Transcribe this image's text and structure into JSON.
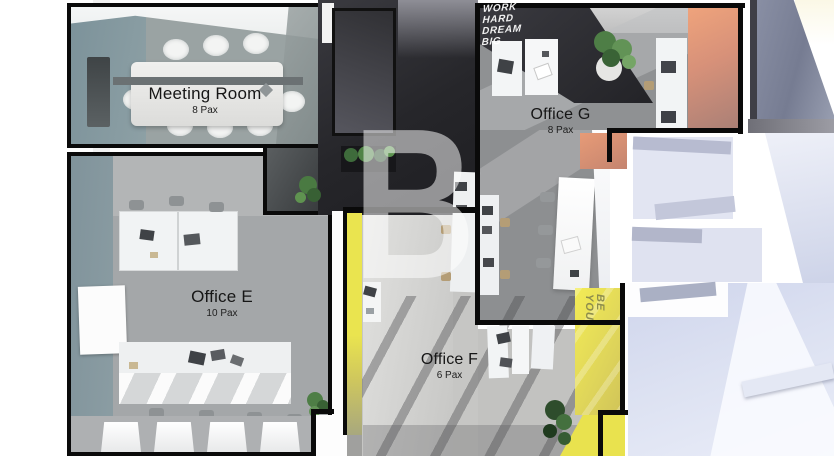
{
  "watermark": "B",
  "rooms": [
    {
      "name": "Meeting Room",
      "capacity": "8 Pax"
    },
    {
      "name": "Office E",
      "capacity": "10 Pax"
    },
    {
      "name": "Office F",
      "capacity": "6 Pax"
    },
    {
      "name": "Office G",
      "capacity": "8 Pax"
    }
  ],
  "wall_art": {
    "motivation_lines": [
      "WORK",
      "HARD",
      "DREAM",
      "BIG"
    ],
    "accent_lines": [
      "BE",
      "YOU"
    ]
  },
  "palette": {
    "yellow_accent_wall": "#E9E34F",
    "orange_accent_wall": "#E79B77",
    "dark_feature_wall": "#2C2C30",
    "slate_wall": "#7F949B",
    "floor_gray": "#A8ABAD",
    "lavender_floor": "#DCE0F0"
  }
}
